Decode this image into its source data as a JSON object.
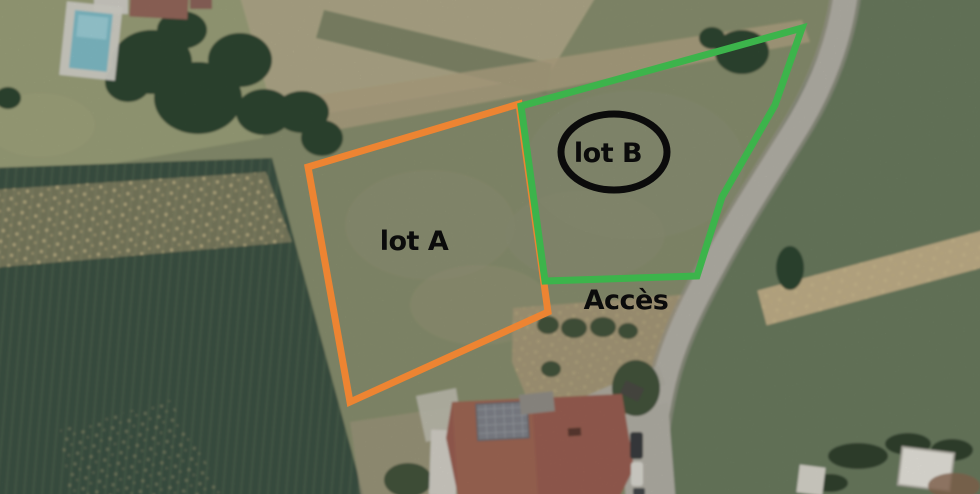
{
  "map": {
    "type": "aerial-parcel-annotation",
    "annotations": {
      "lot_a": {
        "label": "lot A"
      },
      "lot_b": {
        "label": "lot B"
      },
      "access": {
        "label": "Accès"
      }
    },
    "colors": {
      "lot_a_outline": "#ED8432",
      "lot_b_outline": "#3CB44B",
      "ellipse_stroke": "#0B0B0B",
      "label_text": "#0B0B0B"
    }
  }
}
